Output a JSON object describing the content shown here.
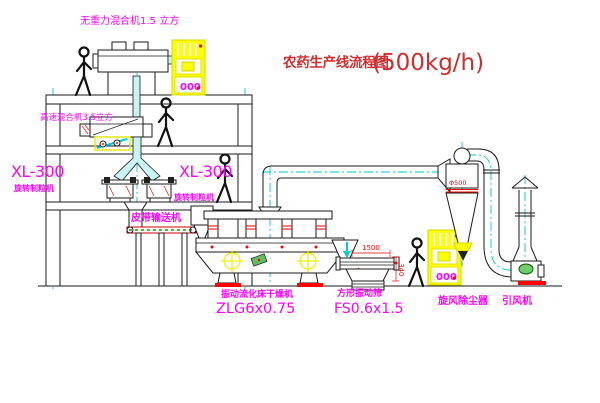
{
  "title": {
    "cn": "农药生产线流程图",
    "capacity": "(500kg/h)"
  },
  "equipment": {
    "top_mixer": "无重力混合机1.5 立方",
    "floor2_mixer": "高速混合机3.5立方",
    "granulator_model_left": "XL-300",
    "granulator_name_left": "旋转制粒机",
    "granulator_model_right": "XL-300",
    "granulator_name_right": "旋转制粒机",
    "belt_conveyor": "皮带输送机",
    "dryer_name": "振动流化床干燥机",
    "dryer_model": "ZLG6x0.75",
    "sieve_name": "方形振动筛",
    "sieve_model": "FS0.6x1.5",
    "cyclone_name": "旋风除尘器",
    "fan_name": "引风机"
  },
  "dimensions": {
    "sieve_length": "1500",
    "sieve_height": "340",
    "cyclone_diameter": "Φ500"
  },
  "control_cabinet": {
    "display": "000"
  },
  "colors": {
    "label_magenta": "#ff00ff",
    "title_red": "#d22c2c",
    "dimension_red": "#ff0000",
    "highlight_yellow": "#ffff00",
    "centerline_cyan": "#00c8c8",
    "line_black": "#1a1a1a",
    "belt_green": "#00aa00"
  }
}
